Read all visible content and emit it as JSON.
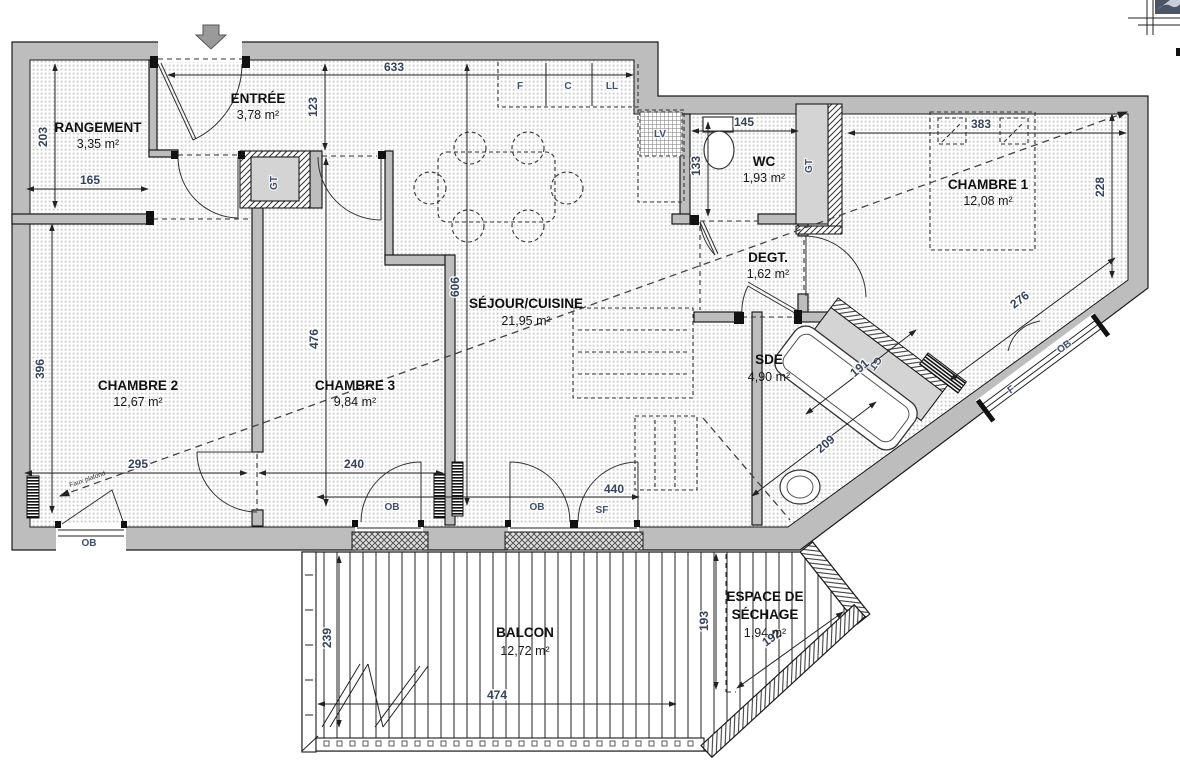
{
  "plan": {
    "rooms": {
      "rangement": {
        "name": "RANGEMENT",
        "area": "3,35 m²"
      },
      "entree": {
        "name": "ENTRÉE",
        "area": "3,78 m²"
      },
      "wc": {
        "name": "WC",
        "area": "1,93 m²"
      },
      "chambre1": {
        "name": "CHAMBRE 1",
        "area": "12,08 m²"
      },
      "degt": {
        "name": "DEGT.",
        "area": "1,62 m²"
      },
      "sejour": {
        "name": "SÉJOUR/CUISINE",
        "area": "21,95 m²"
      },
      "chambre2": {
        "name": "CHAMBRE 2",
        "area": "12,67 m²"
      },
      "chambre3": {
        "name": "CHAMBRE 3",
        "area": "9,84 m²"
      },
      "sde": {
        "name": "SDE",
        "area": "4,90 m²"
      },
      "balcon": {
        "name": "BALCON",
        "area": "12,72 m²"
      },
      "sechage": {
        "line1": "ESPACE DE",
        "line2": "SÉCHAGE",
        "area": "1,94 m²"
      }
    },
    "dims": {
      "d633": "633",
      "d123": "123",
      "d203": "203",
      "d165": "165",
      "d145": "145",
      "d133": "133",
      "d383": "383",
      "d228": "228",
      "d276": "276",
      "d606": "606",
      "d476": "476",
      "d396": "396",
      "d295": "295",
      "d240": "240",
      "d440": "440",
      "d191": "191",
      "d209": "209",
      "d239": "239",
      "d474": "474",
      "d193": "193",
      "d192": "192"
    },
    "tags": {
      "gt": "GT",
      "lv": "LV",
      "ll": "LL",
      "f": "F",
      "c": "C",
      "ob": "OB",
      "sf": "SF",
      "faux_plafond": "Faux plafond"
    },
    "colors": {
      "wall": "#bdbdbd",
      "line": "#1a1a1a",
      "dim": "#36435a",
      "logo": "#4a5666"
    }
  }
}
